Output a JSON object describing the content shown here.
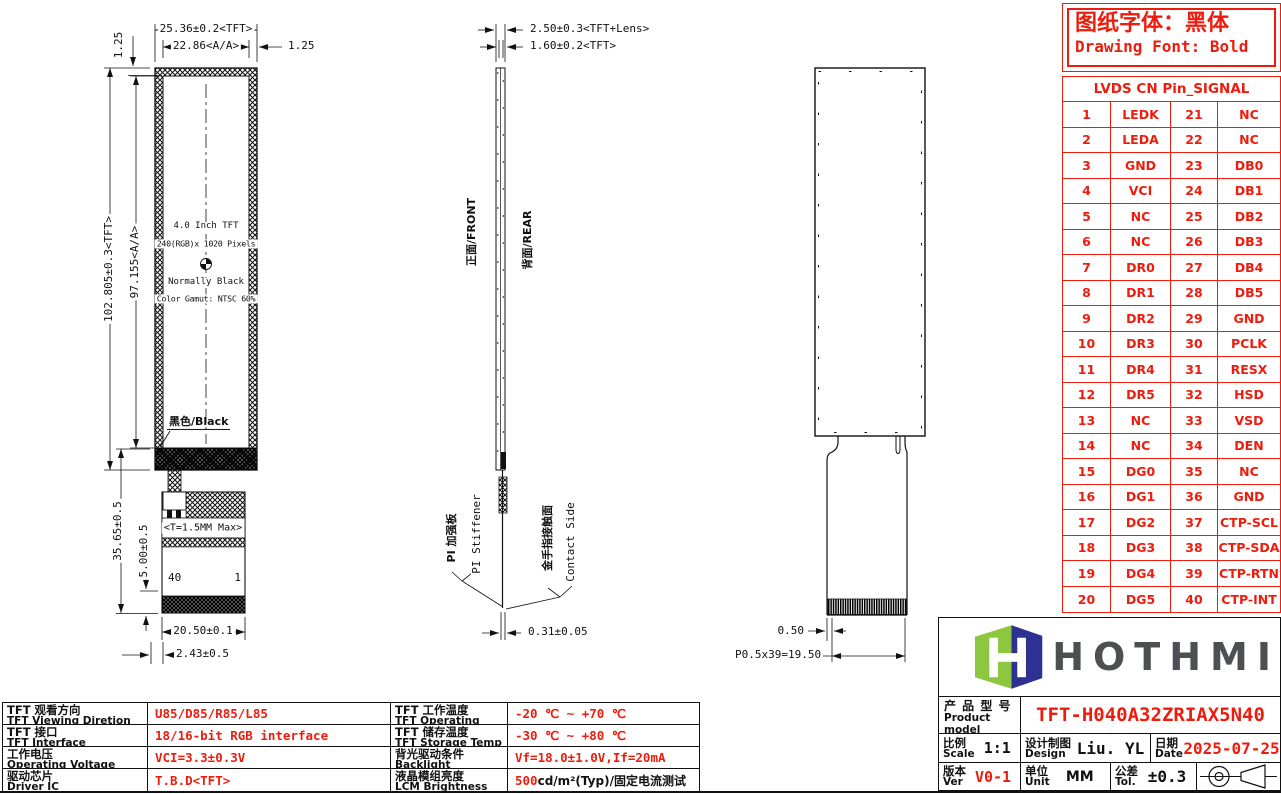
{
  "colors": {
    "accent_red": "#ee1c0d",
    "logo_green": "#8dc63f",
    "logo_navy": "#2e3192",
    "brand_gray": "#4d4f53",
    "line_black": "#111111"
  },
  "font_note": {
    "cn": "图纸字体：黑体",
    "en": "Drawing Font: Bold"
  },
  "front_view": {
    "dim_width_tft": "25.36±0.2<TFT>",
    "dim_width_aa": "22.86<A/A>",
    "dim_margin_right": "1.25",
    "dim_margin_top": "1.25",
    "dim_height_tft": "102.805±0.3<TFT>",
    "dim_height_aa": "97.155<A/A>",
    "size_label": "4.0 Inch TFT",
    "resolution_label": "240(RGB)x 1020 Pixels",
    "mode_label": "Normally Black",
    "gamut_label": "Color Gamut: NTSC 60%",
    "black_label": "黑色/Black",
    "thickness_label": "<T=1.5MM Max>",
    "pin_first": "40",
    "pin_last": "1",
    "dim_tail_length": "35.65±0.5",
    "dim_contact_height": "5.00±0.5",
    "dim_tail_width": "20.50±0.1",
    "dim_tail_offset": "2.43±0.5"
  },
  "side_view": {
    "dim_thickness_lens": "2.50±0.3<TFT+Lens>",
    "dim_thickness_tft": "1.60±0.2<TFT>",
    "front_label": "正面/FRONT",
    "rear_label": "背面/REAR",
    "stiffener_cn": "PI 加强板",
    "stiffener_en": "PI Stiffener",
    "contact_cn": "金手指接触面",
    "contact_en": "Contact Side",
    "dim_fpc_thickness": "0.31±0.05"
  },
  "rear_view": {
    "dim_finger_offset": "0.50",
    "dim_finger_pitch": "P0.5x39=19.50"
  },
  "pin_table": {
    "title": "LVDS CN Pin_SIGNAL",
    "rows": [
      {
        "n1": "1",
        "s1": "LEDK",
        "n2": "21",
        "s2": "NC"
      },
      {
        "n1": "2",
        "s1": "LEDA",
        "n2": "22",
        "s2": "NC"
      },
      {
        "n1": "3",
        "s1": "GND",
        "n2": "23",
        "s2": "DB0"
      },
      {
        "n1": "4",
        "s1": "VCI",
        "n2": "24",
        "s2": "DB1"
      },
      {
        "n1": "5",
        "s1": "NC",
        "n2": "25",
        "s2": "DB2"
      },
      {
        "n1": "6",
        "s1": "NC",
        "n2": "26",
        "s2": "DB3"
      },
      {
        "n1": "7",
        "s1": "DR0",
        "n2": "27",
        "s2": "DB4"
      },
      {
        "n1": "8",
        "s1": "DR1",
        "n2": "28",
        "s2": "DB5"
      },
      {
        "n1": "9",
        "s1": "DR2",
        "n2": "29",
        "s2": "GND"
      },
      {
        "n1": "10",
        "s1": "DR3",
        "n2": "30",
        "s2": "PCLK"
      },
      {
        "n1": "11",
        "s1": "DR4",
        "n2": "31",
        "s2": "RESX"
      },
      {
        "n1": "12",
        "s1": "DR5",
        "n2": "32",
        "s2": "HSD"
      },
      {
        "n1": "13",
        "s1": "NC",
        "n2": "33",
        "s2": "VSD"
      },
      {
        "n1": "14",
        "s1": "NC",
        "n2": "34",
        "s2": "DEN"
      },
      {
        "n1": "15",
        "s1": "DG0",
        "n2": "35",
        "s2": "NC"
      },
      {
        "n1": "16",
        "s1": "DG1",
        "n2": "36",
        "s2": "GND"
      },
      {
        "n1": "17",
        "s1": "DG2",
        "n2": "37",
        "s2": "CTP-SCL"
      },
      {
        "n1": "18",
        "s1": "DG3",
        "n2": "38",
        "s2": "CTP-SDA"
      },
      {
        "n1": "19",
        "s1": "DG4",
        "n2": "39",
        "s2": "CTP-RTN"
      },
      {
        "n1": "20",
        "s1": "DG5",
        "n2": "40",
        "s2": "CTP-INT"
      }
    ]
  },
  "spec_table": {
    "rows": [
      {
        "lcn": "TFT 观看方向",
        "len": "TFT Viewing Diretion",
        "lval": "U85/D85/R85/L85",
        "rcn": "TFT 工作温度",
        "ren": "TFT Operating Temp",
        "rval": "-20 ℃ ~ +70 ℃"
      },
      {
        "lcn": "TFT 接口",
        "len": "TFT Interface",
        "lval": "18/16-bit RGB interface",
        "rcn": "TFT 储存温度",
        "ren": "TFT Storage Temp",
        "rval": "-30 ℃ ~ +80 ℃"
      },
      {
        "lcn": "工作电压",
        "len": "Operating Voltage",
        "lval": "VCI=3.3±0.3V",
        "rcn": "背光驱动条件",
        "ren": "Backlight conditions",
        "rval": "Vf=18.0±1.0V,If=20mA"
      },
      {
        "lcn": "驱动芯片",
        "len": "Driver IC",
        "lval": "T.B.D<TFT>",
        "rcn": "液晶模组亮度",
        "ren": "LCM Brightness",
        "rval": "500",
        "rsuffix": " cd/m²(Typ)/固定电流测试"
      }
    ]
  },
  "title_block": {
    "brand": "HOTHMI",
    "product_label_cn": "产 品 型 号",
    "product_label_en": "Product model",
    "product_model": "TFT-H040A32ZRIAX5N40",
    "scale_cn": "比例",
    "scale_en": "Scale",
    "scale_value": "1:1",
    "design_cn": "设计制图",
    "design_en": "Design",
    "design_value": "Liu. YL",
    "date_cn": "日期",
    "date_en": "Date",
    "date_value": "2025-07-25",
    "ver_cn": "版本",
    "ver_en": "Ver",
    "ver_value": "V0-1",
    "unit_cn": "单位",
    "unit_en": "Unit",
    "unit_value": "MM",
    "tol_cn": "公差",
    "tol_en": "Tol.",
    "tol_value": "±0.3"
  }
}
